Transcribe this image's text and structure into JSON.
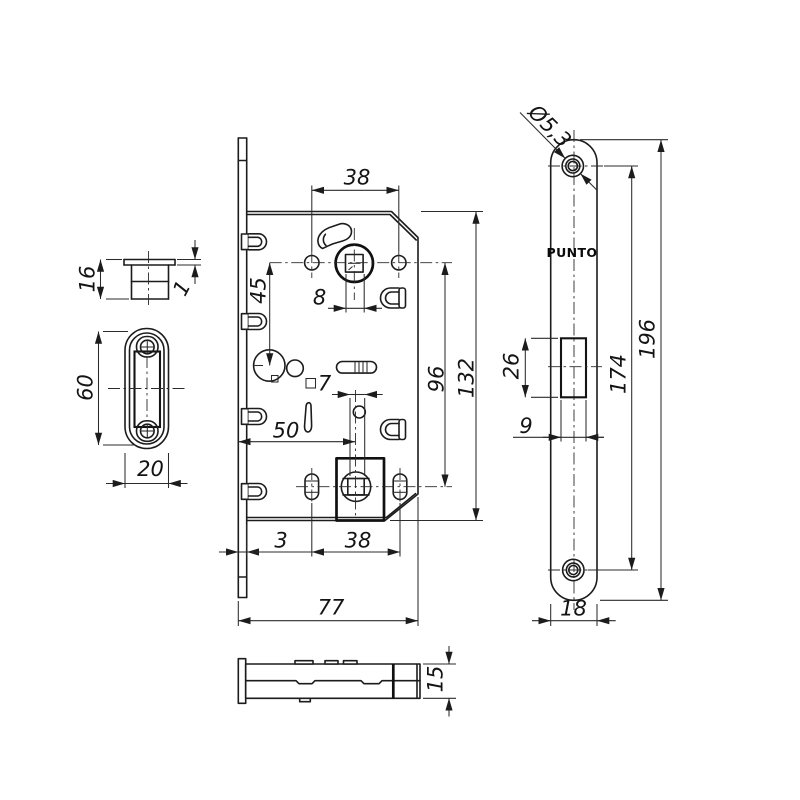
{
  "page": {
    "background": "#ffffff",
    "line_color": "#1c1c1c"
  },
  "views": {
    "catch_section": {
      "dims": {
        "height": "16",
        "lip": "1"
      }
    },
    "strike_plate": {
      "dims": {
        "height": "60",
        "width": "20"
      }
    },
    "lock_body": {
      "dims": {
        "top_holes_span": "38",
        "wc_offset": "45",
        "spindle_square": "8",
        "wc_square": "7",
        "backset": "50",
        "centers_span": "96",
        "body_height": "132",
        "faceplate_thickness": "3",
        "bottom_holes_span": "38",
        "body_width": "77"
      }
    },
    "faceplate": {
      "brand": "PUNTO",
      "dims": {
        "screw_hole": "Ø5,3",
        "height": "196",
        "screw_centers": "174",
        "latch_height": "26",
        "latch_width": "9",
        "width": "18"
      }
    },
    "side_view": {
      "dims": {
        "thickness": "15"
      }
    }
  }
}
